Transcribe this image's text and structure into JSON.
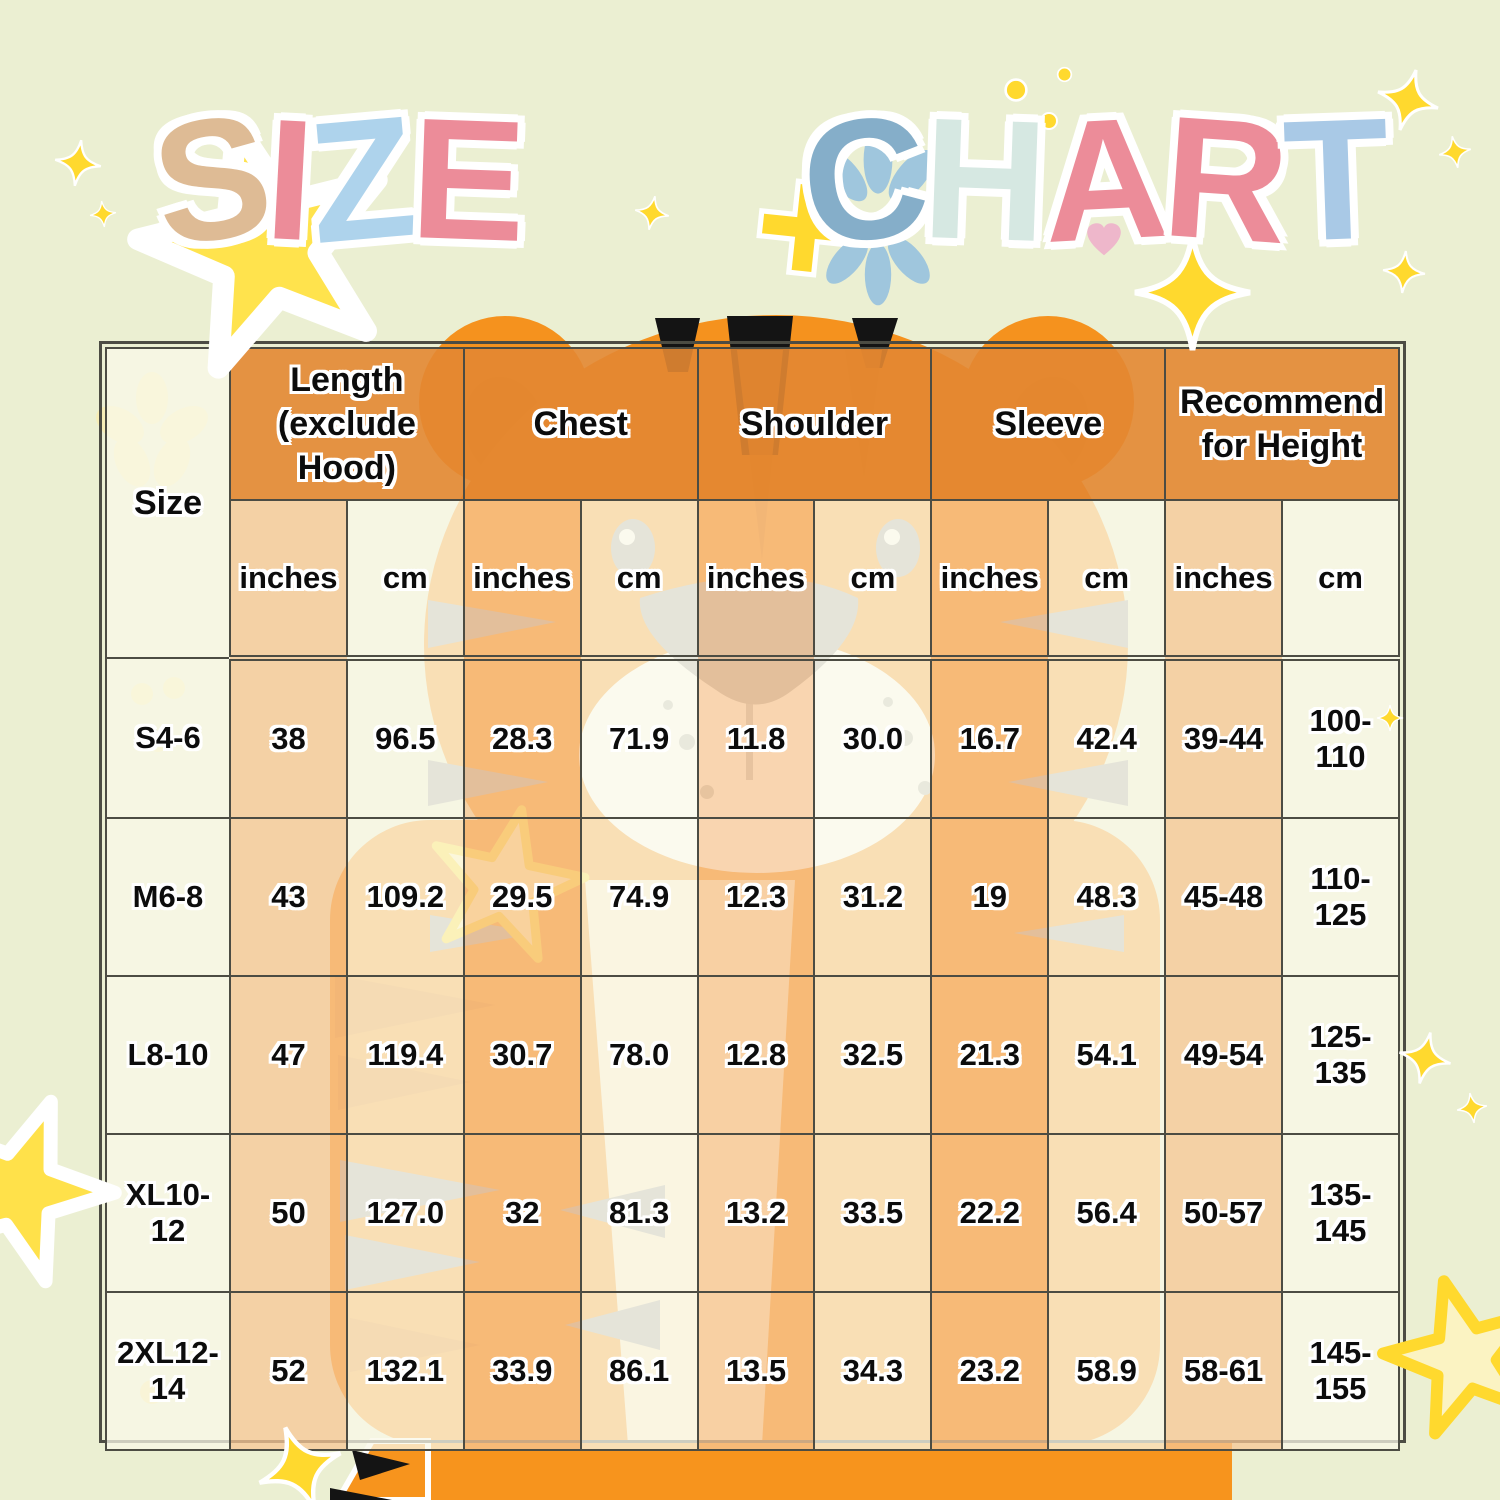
{
  "title": {
    "words": [
      {
        "text": "SIZE",
        "colors": [
          "#debb95",
          "#ec8c99",
          "#aed3ec",
          "#ec8c99"
        ]
      },
      {
        "text": "CHART",
        "colors": [
          "#85aec9",
          "#d6e8e2",
          "#ec8c99",
          "#ec8c99",
          "#a9c9e6"
        ]
      }
    ]
  },
  "table": {
    "size_header": "Size",
    "groups": [
      "Length (exclude Hood)",
      "Chest",
      "Shoulder",
      "Sleeve",
      "Recommend for Height"
    ],
    "unit_inches": "inches",
    "unit_cm": "cm"
  },
  "chart_data": {
    "type": "table",
    "title": "SIZE CHART",
    "column_groups": [
      "Size",
      "Length (exclude Hood)",
      "Chest",
      "Shoulder",
      "Sleeve",
      "Recommend for Height"
    ],
    "units_per_group": [
      "inches",
      "cm"
    ],
    "columns": [
      "Size",
      "Length (exclude Hood) inches",
      "Length (exclude Hood) cm",
      "Chest inches",
      "Chest cm",
      "Shoulder inches",
      "Shoulder cm",
      "Sleeve inches",
      "Sleeve cm",
      "Recommend for Height inches",
      "Recommend for Height cm"
    ],
    "rows": [
      {
        "size": "S4-6",
        "values": [
          "38",
          "96.5",
          "28.3",
          "71.9",
          "11.8",
          "30.0",
          "16.7",
          "42.4",
          "39-44",
          "100-110"
        ]
      },
      {
        "size": "M6-8",
        "values": [
          "43",
          "109.2",
          "29.5",
          "74.9",
          "12.3",
          "31.2",
          "19",
          "48.3",
          "45-48",
          "110-125"
        ]
      },
      {
        "size": "L8-10",
        "values": [
          "47",
          "119.4",
          "30.7",
          "78.0",
          "12.8",
          "32.5",
          "21.3",
          "54.1",
          "49-54",
          "125-135"
        ]
      },
      {
        "size": "XL10-12",
        "values": [
          "50",
          "127.0",
          "32",
          "81.3",
          "13.2",
          "33.5",
          "22.2",
          "56.4",
          "50-57",
          "135-145"
        ]
      },
      {
        "size": "2XL12-14",
        "values": [
          "52",
          "132.1",
          "33.9",
          "86.1",
          "13.5",
          "34.3",
          "23.2",
          "58.9",
          "58-61",
          "145-155"
        ]
      }
    ]
  },
  "colors": {
    "background": "#ebefd2",
    "header_orange": "#e38732",
    "cell_peach": "#f7c796",
    "cell_cream": "#faf8e8",
    "grid_line": "#4c4c43",
    "tiger_orange": "#f5921e",
    "tiger_bright_orange": "#f7941d",
    "tiger_gray": "#a6a8ab",
    "sparkle_gold": "#ffd92e",
    "star_yellow": "#ffe34d"
  },
  "decorations": [
    {
      "name": "star-behind-s-icon",
      "type": "star5",
      "x": 268,
      "y": 252,
      "s": 270,
      "rot": -14,
      "fill": "#ffe34d",
      "stroke": "#ffffff",
      "sw": 8
    },
    {
      "name": "sparkle-top-left-icon",
      "type": "sparkle4",
      "x": 78,
      "y": 163,
      "s": 46,
      "rot": 8,
      "fill": "#ffd92e"
    },
    {
      "name": "sparkle-top-left-2-icon",
      "type": "sparkle4",
      "x": 103,
      "y": 214,
      "s": 26,
      "rot": -6,
      "fill": "#ffd92e"
    },
    {
      "name": "sparkle-after-size-icon",
      "type": "sparkle4",
      "x": 652,
      "y": 213,
      "s": 34,
      "rot": 10,
      "fill": "#ffd92e"
    },
    {
      "name": "dot-above-h-icon",
      "type": "dot",
      "x": 1016,
      "y": 90,
      "s": 26,
      "fill": "#ffd92e"
    },
    {
      "name": "dot-above-h-2-icon",
      "type": "dot",
      "x": 1049,
      "y": 121,
      "s": 20,
      "fill": "#ffd92e"
    },
    {
      "name": "dot-above-h-3-icon",
      "type": "dot",
      "x": 1064,
      "y": 74,
      "s": 17,
      "fill": "#ffd92e"
    },
    {
      "name": "plus-behind-c-icon",
      "type": "plus",
      "x": 806,
      "y": 228,
      "s": 104,
      "rot": 6,
      "fill": "#ffd92e"
    },
    {
      "name": "blue-fan-upper-icon",
      "type": "fan",
      "x": 878,
      "y": 178,
      "s": 120,
      "rot": 0,
      "fill": "#9fc6dd"
    },
    {
      "name": "blue-fan-lower-icon",
      "type": "fan",
      "x": 878,
      "y": 258,
      "s": 110,
      "rot": 180,
      "fill": "#9fc6dd"
    },
    {
      "name": "heart-in-a-icon",
      "type": "heart",
      "x": 1104,
      "y": 240,
      "s": 40,
      "fill": "#eeb7cb"
    },
    {
      "name": "big-sparkle-under-r-icon",
      "type": "sparkle4",
      "x": 1192,
      "y": 292,
      "s": 115,
      "rot": 0,
      "fill": "#ffd92e"
    },
    {
      "name": "sparkle-top-right-icon",
      "type": "sparkle4",
      "x": 1408,
      "y": 100,
      "s": 62,
      "rot": 15,
      "fill": "#ffd92e"
    },
    {
      "name": "sparkle-top-right-2-icon",
      "type": "sparkle4",
      "x": 1455,
      "y": 152,
      "s": 32,
      "rot": -10,
      "fill": "#ffd92e"
    },
    {
      "name": "sparkle-right-icon",
      "type": "sparkle4",
      "x": 1404,
      "y": 272,
      "s": 42,
      "rot": 5,
      "fill": "#ffd92e"
    },
    {
      "name": "sparkle-mid-right-icon",
      "type": "sparkle4",
      "x": 1390,
      "y": 718,
      "s": 26,
      "rot": 0,
      "fill": "#ffd92e"
    },
    {
      "name": "sparkle-lower-right-icon",
      "type": "sparkle4",
      "x": 1425,
      "y": 1058,
      "s": 52,
      "rot": 12,
      "fill": "#ffd92e"
    },
    {
      "name": "sparkle-lower-right-2-icon",
      "type": "sparkle4",
      "x": 1472,
      "y": 1108,
      "s": 30,
      "rot": -8,
      "fill": "#ffd92e"
    },
    {
      "name": "star-bottom-right-icon",
      "type": "star5",
      "x": 1465,
      "y": 1360,
      "s": 170,
      "rot": -15,
      "fill": "#fbf3c2",
      "stroke": "#ffd92e",
      "sw": 7
    },
    {
      "name": "star-left-edge-icon",
      "type": "star5",
      "x": 18,
      "y": 1192,
      "s": 200,
      "rot": 20,
      "fill": "#ffe14a",
      "stroke": "#ffffff",
      "sw": 7
    },
    {
      "name": "sparkle-bottom-left-icon",
      "type": "sparkle4",
      "x": 300,
      "y": 1468,
      "s": 86,
      "rot": -20,
      "fill": "#ffd92e"
    }
  ]
}
